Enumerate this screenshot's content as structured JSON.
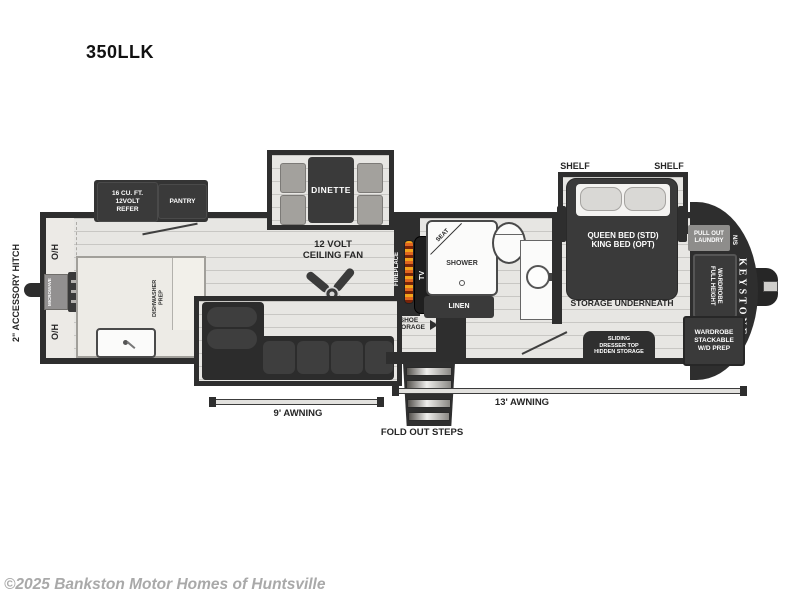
{
  "page": {
    "model": "350LLK",
    "watermark": "©2025 Bankston Motor Homes of Huntsville"
  },
  "exterior": {
    "accessory_hitch": "2\" ACCESSORY HITCH",
    "awning_rear": "9' AWNING",
    "awning_main": "13' AWNING",
    "fold_out_steps": "FOLD OUT STEPS",
    "brand": "KEYSTONE"
  },
  "kitchen": {
    "overhead_top": "O/H",
    "overhead_bottom": "O/H",
    "microwave": "MICROWAVE",
    "refrigerator": "16 CU. FT.\n12VOLT\nREFER",
    "pantry": "PANTRY",
    "dishwasher_prep": "DISHWASHER\nPREP"
  },
  "living": {
    "dinette": "DINETTE",
    "ceiling_fan": "12 VOLT\nCEILING FAN",
    "fireplace": "FIREPLACE",
    "tv": "TV",
    "shoe_storage": "SHOE\nSTORAGE"
  },
  "bathroom": {
    "seat": "SEAT",
    "shower": "SHOWER",
    "linen": "LINEN"
  },
  "bedroom": {
    "shelf_left": "SHELF",
    "shelf_right": "SHELF",
    "bed": "QUEEN BED (STD)\nKING BED (OPT)",
    "storage_underneath": "STORAGE UNDERNEATH",
    "pull_out_laundry": "PULL OUT\nLAUNDRY",
    "night_stand": "N/S",
    "full_height_wardrobe": "FULL HEIGHT\nWARDROBE",
    "wardrobe_stackable": "WARDROBE\nSTACKABLE\nW/D PREP",
    "sliding_dresser_storage": "SLIDING\nDRESSER TOP\nHIDDEN STORAGE"
  },
  "colors": {
    "wall": "#2e2e2e",
    "cabinet_dark": "#3a3a3a",
    "floor_light": "#e7e6e3",
    "counter": "#edebe6",
    "bench_gray": "#a3a19d",
    "label_gray": "#8e8d8b",
    "flame_orange": "#e0661f",
    "watermark_gray": "#a9a9a9"
  }
}
